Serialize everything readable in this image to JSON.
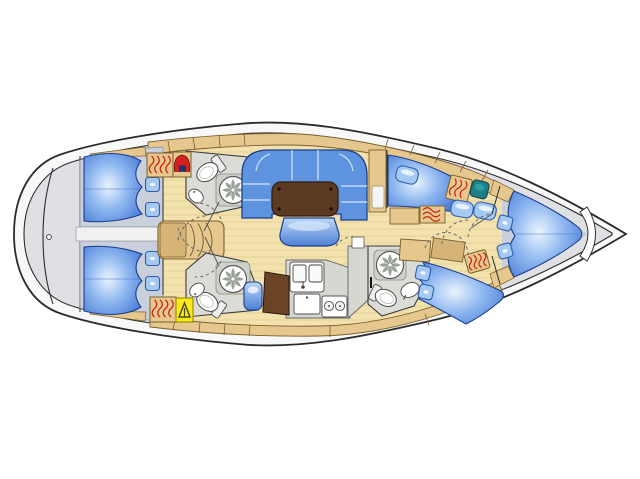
{
  "page": {
    "background": "#ffffff",
    "content": "yacht interior deck plan, top-down, bow pointing right, no visible text labels"
  },
  "vessel": {
    "view": "top-down interior layout diagram",
    "bow_direction": "right",
    "stern_direction": "left",
    "areas": [
      {
        "name": "swim-platform-transom"
      },
      {
        "name": "aft-cabin-port",
        "double_berth": 1,
        "pillows": 2
      },
      {
        "name": "aft-cabin-starboard",
        "double_berth": 1,
        "pillows": 2
      },
      {
        "name": "companionway-stairs"
      },
      {
        "name": "head-port-aft",
        "fixtures": [
          "toilet",
          "shower",
          "washbasin"
        ]
      },
      {
        "name": "head-starboard-aft",
        "fixtures": [
          "toilet",
          "shower",
          "washbasin"
        ]
      },
      {
        "name": "saloon",
        "furniture": [
          "u-shaped-settee",
          "dining-table",
          "seat"
        ]
      },
      {
        "name": "galley",
        "equipment": [
          "double-sink",
          "two-burner-stove",
          "refrigerator",
          "counter"
        ]
      },
      {
        "name": "chart-table",
        "furniture": [
          "chart-table",
          "navigator-seat"
        ]
      },
      {
        "name": "head-forward-starboard",
        "fixtures": [
          "toilet",
          "shower",
          "washbasin"
        ]
      },
      {
        "name": "forward-cabin-port",
        "double_berth": 1,
        "pillows": 3
      },
      {
        "name": "forward-cabin-starboard",
        "double_berth": 1,
        "pillows": 2
      },
      {
        "name": "owners-cabin-bow",
        "v_berth": 1,
        "pillows": 2
      },
      {
        "name": "anchor-locker-bow"
      }
    ],
    "hanging_lockers": 5,
    "shower_circles": 3,
    "door_swing_arcs": "dashed"
  },
  "colors": {
    "background": "#ffffff",
    "hull_band": "#f8f8f8",
    "hull_outline": "#2b2b2b",
    "interior_gray": "#dfe0e3",
    "cabin_floor": "#c9cfdb",
    "walkway": "#f0f0f0",
    "wood_floor": "#f3e2ae",
    "plank_line": "#d9c183",
    "tan": "#e6c88f",
    "tan_dark": "#d6b477",
    "tan_outline": "#7a5e2e",
    "head_floor": "#dadcd5",
    "head_wall": "#3c3c3c",
    "shower_tray": "#ccd2c9",
    "fixture_white": "#ffffff",
    "fixture_outline": "#4a4a4a",
    "blade_gray": "#9aa39a",
    "berth_light": "#eaf4fe",
    "berth_mid": "#8fb8f0",
    "berth_dark": "#3f72d2",
    "berth_outline": "#1c3f8e",
    "pillow": "#a5c9f3",
    "pillow_outline": "#2f5fae",
    "settee": "#5e93e0",
    "seam": "#cfe2fa",
    "table": "#5d3a22",
    "table_outline": "#2d1b0e",
    "chart_table": "#6b4426",
    "galley_gray": "#d7d7d2",
    "hatch_red": "#cc2412",
    "icon_red": "#d42020",
    "icon_navy": "#20306e",
    "icon_yellow": "#ffe81a",
    "icon_dark": "#4a4a20",
    "sink_teal": "#1d7f86",
    "door_dash": "#666666"
  }
}
